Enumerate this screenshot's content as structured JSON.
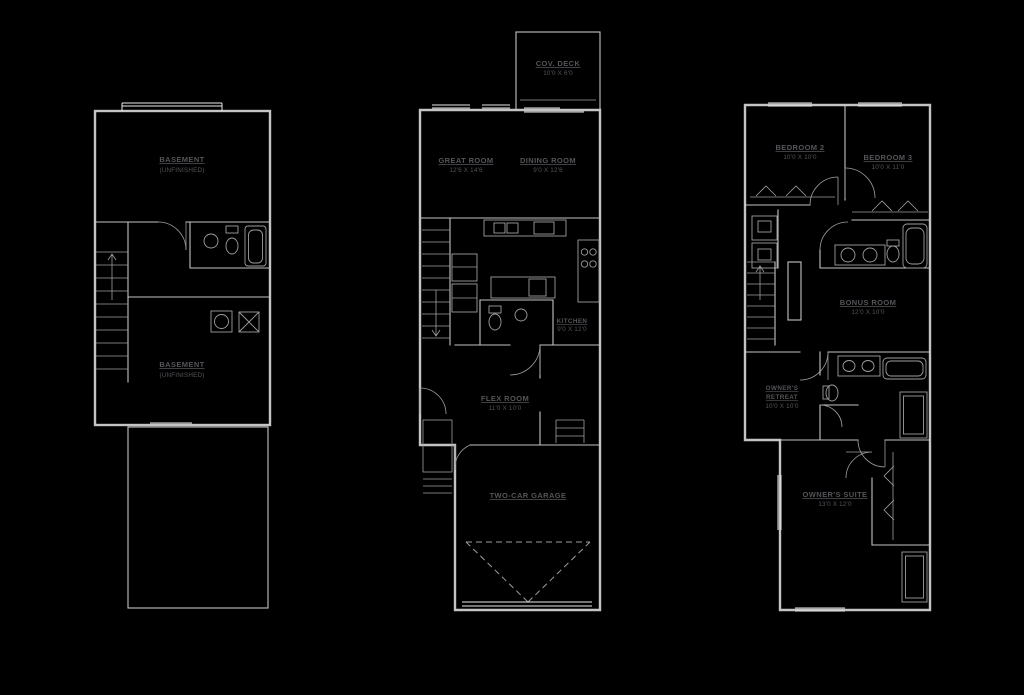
{
  "colors": {
    "background": "#000000",
    "line": "#c4c4c4",
    "text": "#55555a"
  },
  "plans": {
    "basement": {
      "upper_room": {
        "name": "BASEMENT",
        "dims": "(UNFINISHED)"
      },
      "lower_room": {
        "name": "BASEMENT",
        "dims": "(UNFINISHED)"
      }
    },
    "main": {
      "deck": {
        "name": "COV. DECK",
        "dims": "10'0 X 6'0"
      },
      "great_room": {
        "name": "GREAT ROOM",
        "dims": "12'6 X 14'6"
      },
      "dining_room": {
        "name": "DINING ROOM",
        "dims": "9'0 X 12'6"
      },
      "kitchen": {
        "name": "KITCHEN",
        "dims": "9'0 X 12'0"
      },
      "flex_room": {
        "name": "FLEX ROOM",
        "dims": "11'0 X 10'0"
      },
      "garage": {
        "name": "TWO-CAR GARAGE"
      }
    },
    "upper": {
      "bedroom2": {
        "name": "BEDROOM 2",
        "dims": "10'0 X 10'0"
      },
      "bedroom3": {
        "name": "BEDROOM 3",
        "dims": "10'0 X 11'0"
      },
      "bonus_room": {
        "name": "BONUS ROOM",
        "dims": "12'0 X 10'0"
      },
      "owners_retreat": {
        "name": "OWNER'S",
        "name2": "RETREAT",
        "dims": "10'0 X 10'0"
      },
      "owners_suite": {
        "name": "OWNER'S SUITE",
        "dims": "13'0 X 12'0"
      }
    }
  }
}
